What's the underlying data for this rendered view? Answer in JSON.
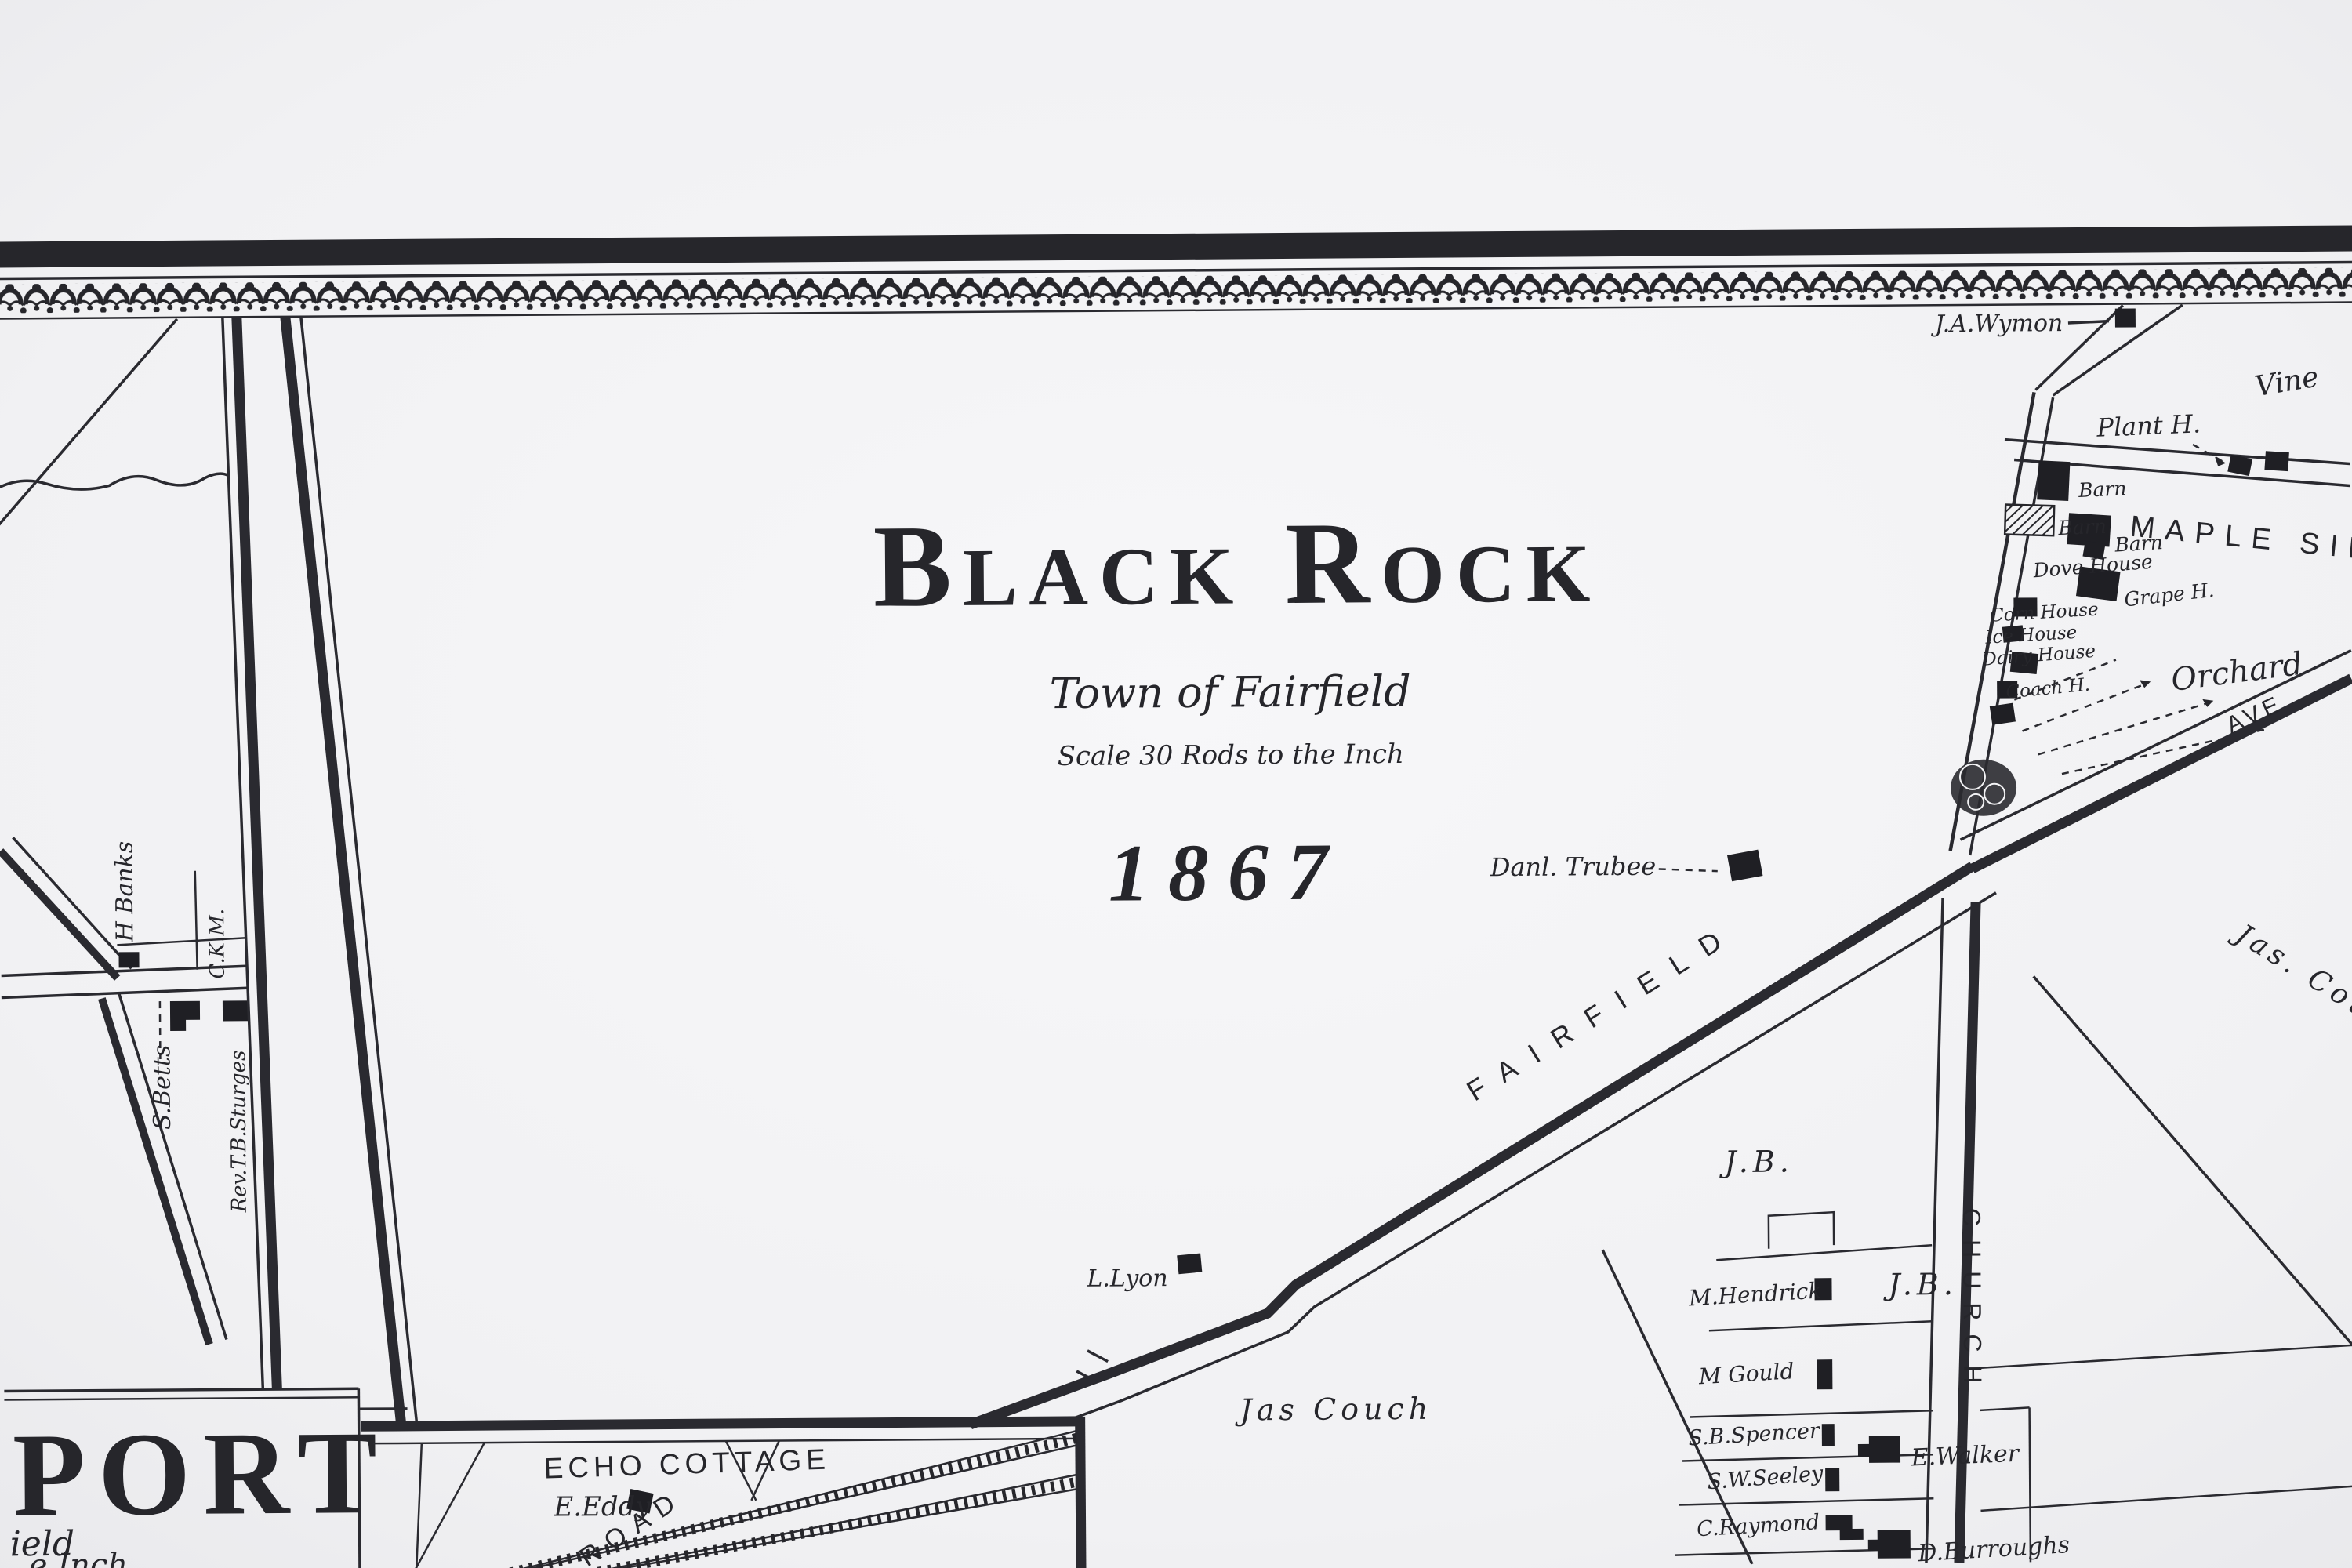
{
  "colors": {
    "paper": "#f2f2f4",
    "ink": "#26262b"
  },
  "title_block": {
    "name": "Black Rock",
    "region": "Town of Fairfield",
    "scale": "Scale 30 Rods to the Inch",
    "year": "1867"
  },
  "roads": {
    "fairfield": "FAIRFIELD",
    "church": "CHURCH",
    "avenue": "AVE",
    "echo_road": "ROAD"
  },
  "districts": {
    "maple_side": "MAPLE SID",
    "orchard": "Orchard",
    "echo_cottage": "ECHO COTTAGE"
  },
  "owners": {
    "wymon": "J.A.Wymon",
    "vine": "Vine",
    "plant_h": "Plant H.",
    "trubee": "Danl. Trubee",
    "lyon": "L.Lyon",
    "jas_couch": "Jas Couch",
    "jas_cou": "Jas. Cou",
    "jb_upper": "J.B.",
    "jb_lower": "J.B.",
    "hendrick": "M.Hendrick",
    "gould": "M Gould",
    "spencer": "S.B.Spencer",
    "seeley": "S.W.Seeley",
    "raymond": "C.Raymond",
    "walker": "E.Walker",
    "burroughs": "D.Burroughs",
    "banks": "H Banks",
    "ckm": "C.K.M.",
    "betts": "S.Betts",
    "sturges": "Rev.T.B.Sturges",
    "eddy": "E.Eddy"
  },
  "farm_buildings": {
    "barn_a": "Barn",
    "barn_b": "Barn",
    "barn_c": "Barn",
    "dove_house": "Dove House",
    "grape_house": "Grape H.",
    "corn_house": "Corn House",
    "ice_house": "Ice House",
    "dairy_house": "Dairy House",
    "coach_house": "Coach H."
  },
  "inset_bridgeport": {
    "title_fragment": "PORT",
    "subtitle_fragment": "ield",
    "scale_fragment": "e Inch"
  }
}
